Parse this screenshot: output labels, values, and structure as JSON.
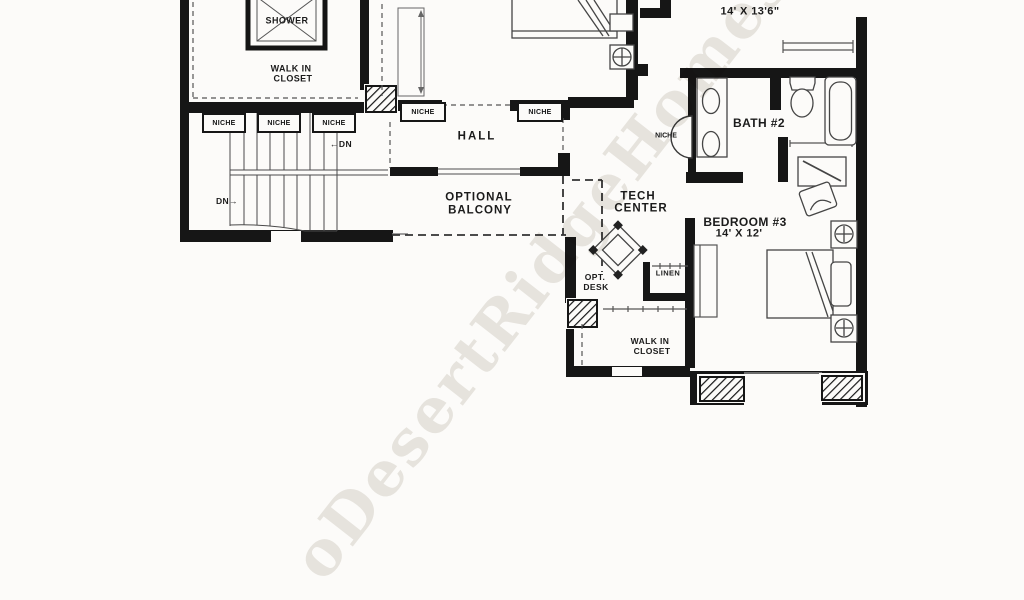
{
  "plan": {
    "rooms": {
      "shower": "SHOWER",
      "walk_in_closet_top": {
        "line1": "WALK IN",
        "line2": "CLOSET"
      },
      "hall": "HALL",
      "optional_balcony": {
        "line1": "OPTIONAL",
        "line2": "BALCONY"
      },
      "tech_center": {
        "line1": "TECH",
        "line2": "CENTER"
      },
      "opt_desk": {
        "line1": "OPT.",
        "line2": "DESK"
      },
      "linen": "LINEN",
      "walk_in_closet_bed3": {
        "line1": "WALK IN",
        "line2": "CLOSET"
      },
      "bath2": "BATH #2",
      "bedroom2": {
        "name": "BEDROOM #2",
        "dims": "14' X 13'6\""
      },
      "bedroom3": {
        "name": "BEDROOM #3",
        "dims": "14' X 12'"
      }
    },
    "annotations": {
      "niche": "NICHE",
      "dn_left": "←DN",
      "dn_right": "DN→"
    }
  },
  "watermark": {
    "text": "oDesertRidgeHomes"
  }
}
